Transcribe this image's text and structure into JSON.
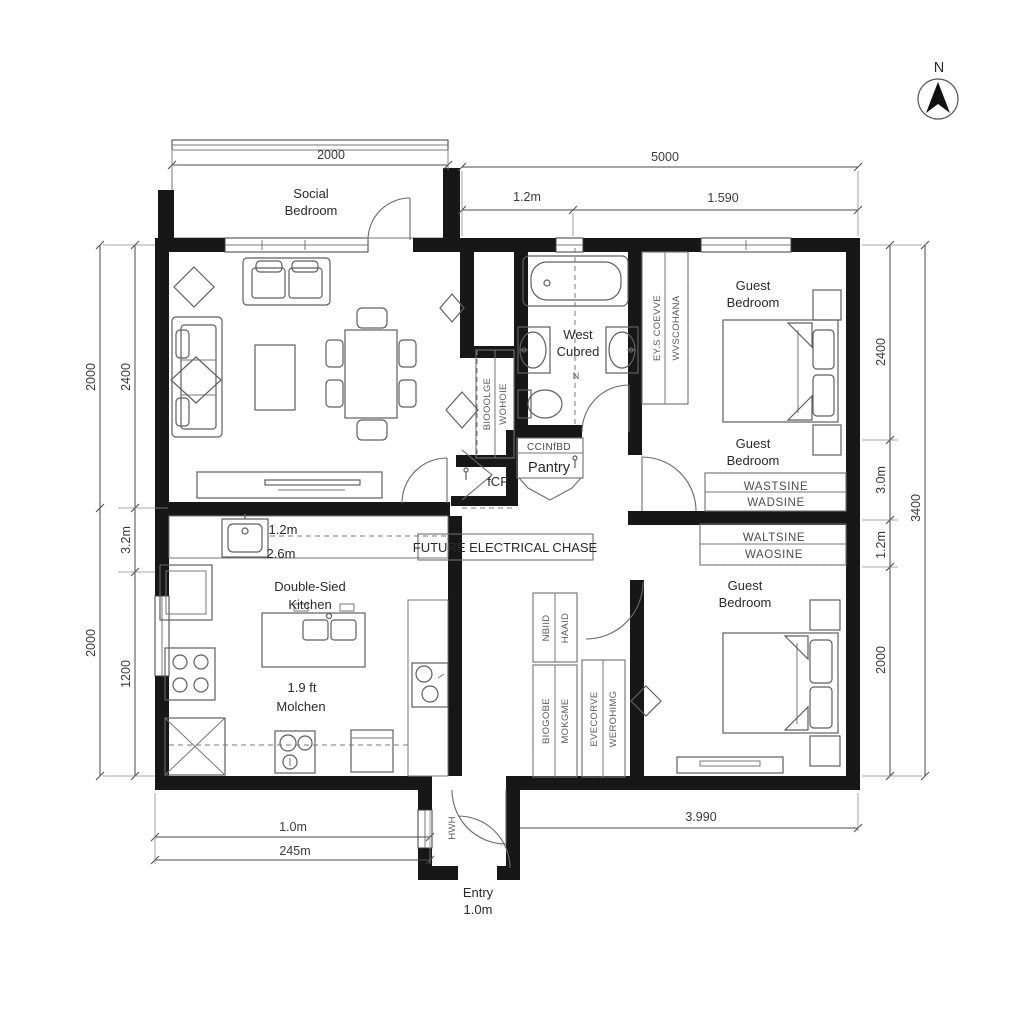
{
  "compass": {
    "label": "N"
  },
  "dimensions": {
    "top": {
      "porch": "2000",
      "overall": "5000",
      "seg1": "1.2m",
      "seg2": "1.590"
    },
    "left": {
      "outer_top": "2000",
      "inner_top": "2400",
      "inner_mid": "3.2m",
      "outer_bottom": "2000",
      "inner_bottom": "1200"
    },
    "right": {
      "inner_top": "2400",
      "inner_mid1": "3.0m",
      "inner_mid2": "1.2m",
      "inner_bottom": "2000",
      "outer": "3400"
    },
    "bottom": {
      "line1": "1.0m",
      "line2": "245m",
      "right": "3.990"
    }
  },
  "rooms": {
    "social_bedroom": {
      "line1": "Social",
      "line2": "Bedroom"
    },
    "bathroom": {
      "line1": "West",
      "line2": "Cubred",
      "marker": "N"
    },
    "guest_bedroom_top": {
      "line1": "Guest",
      "line2": "Bedroom"
    },
    "guest_bedroom_mid": {
      "line1": "Guest",
      "line2": "Bedroom"
    },
    "guest_bedroom_bottom": {
      "line1": "Guest",
      "line2": "Bedroom"
    },
    "kitchen": {
      "dims1": "1.2m",
      "dims2": "2.6m",
      "line1": "Double-Sied",
      "line2": "Kitchen",
      "alt1": "1.9 ft",
      "alt2": "Molchen"
    },
    "pantry": {
      "header": "CCINfBD",
      "label": "Pantry"
    },
    "entry": {
      "line1": "Entry",
      "line2": "1.0m"
    }
  },
  "annotations": {
    "electrical_chase": "FUTURE ELECTRICAL CHASE",
    "icp": "fCP.",
    "closet_hall_label1": "BIOOOLGE",
    "closet_hall_label2": "WOHOIE",
    "bath_wardrobe_label1": "EY.S COEVVE",
    "bath_wardrobe_label2": "WVSCOHANA",
    "wardrobe_top_label1": "WASTSINE",
    "wardrobe_top_label2": "WADSINE",
    "wardrobe_mid_label1": "WALTSINE",
    "wardrobe_mid_label2": "WAOSINE",
    "hall_cabinet_small1": "NBIID",
    "hall_cabinet_small2": "HAAID",
    "hall_cabinet_left1": "BIOGOBE",
    "hall_cabinet_left2": "MOKGME",
    "hall_cabinet_right1": "EVECORVE",
    "hall_cabinet_right2": "WEROHIMG",
    "entry_side": "HWH"
  },
  "colors": {
    "wall": "#171717",
    "line": "#5f5f5f",
    "background": "#ffffff"
  }
}
